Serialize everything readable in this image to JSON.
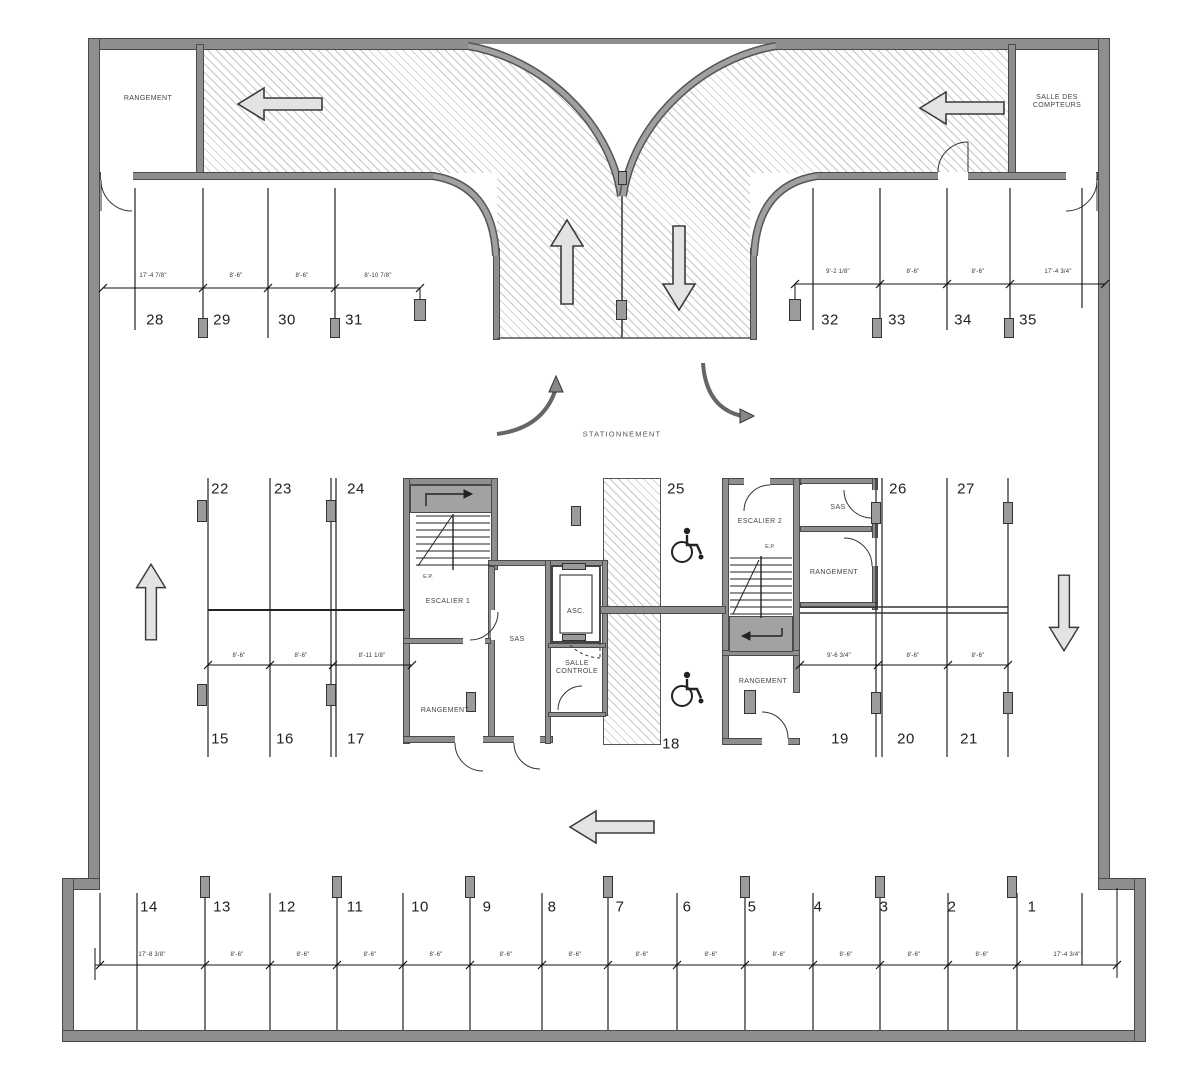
{
  "plan": {
    "aisle_label": "STATIONNEMENT",
    "rooms": {
      "rangement_top_left": "RANGEMENT",
      "salle_des_compteurs": "SALLE DES\nCOMPTEURS",
      "escalier_1": "ESCALIER 1",
      "escalier_2": "ESCALIER 2",
      "sas_center": "SAS",
      "sas_right": "SAS",
      "ascenseur": "ASC.",
      "salle_controle": "SALLE\nCONTROLE",
      "rangement_center": "RANGEMENT",
      "rangement_right": "RANGEMENT",
      "rangement_right_bottom": "RANGEMENT",
      "ep_left": "E.P.",
      "ep_right": "E.P."
    },
    "spaces": {
      "top_left": [
        "28",
        "29",
        "30",
        "31"
      ],
      "top_right": [
        "32",
        "33",
        "34",
        "35"
      ],
      "mid_top_left": [
        "22",
        "23",
        "24"
      ],
      "mid_top_right": [
        "25",
        "26",
        "27"
      ],
      "mid_bottom_left": [
        "15",
        "16",
        "17"
      ],
      "mid_bottom_right": [
        "18",
        "19",
        "20",
        "21"
      ],
      "bottom": [
        "14",
        "13",
        "12",
        "11",
        "10",
        "9",
        "8",
        "7",
        "6",
        "5",
        "4",
        "3",
        "2",
        "1"
      ]
    },
    "dimensions": {
      "top_left": [
        "17'-4 7/8\"",
        "8'-6\"",
        "8'-6\"",
        "8'-10 7/8\""
      ],
      "top_right": [
        "9'-2 1/8\"",
        "8'-6\"",
        "8'-6\"",
        "17'-4 3/4\""
      ],
      "mid_left": [
        "8'-6\"",
        "8'-6\"",
        "8'-11 1/8\""
      ],
      "mid_right": [
        "9'-6 3/4\"",
        "8'-6\"",
        "8'-6\""
      ],
      "bottom": [
        "17'-8 3/8\"",
        "8'-6\"",
        "8'-6\"",
        "8'-6\"",
        "8'-6\"",
        "8'-6\"",
        "8'-6\"",
        "8'-6\"",
        "8'-6\"",
        "8'-6\"",
        "8'-6\"",
        "8'-6\"",
        "8'-6\"",
        "17'-4 3/4\""
      ]
    },
    "colors": {
      "wall": "#8e8e8e",
      "wall_edge": "#4a4a4a",
      "line": "#1c1c1c",
      "hatch": "#c6c6c6",
      "post": "#9b9b9b"
    }
  }
}
